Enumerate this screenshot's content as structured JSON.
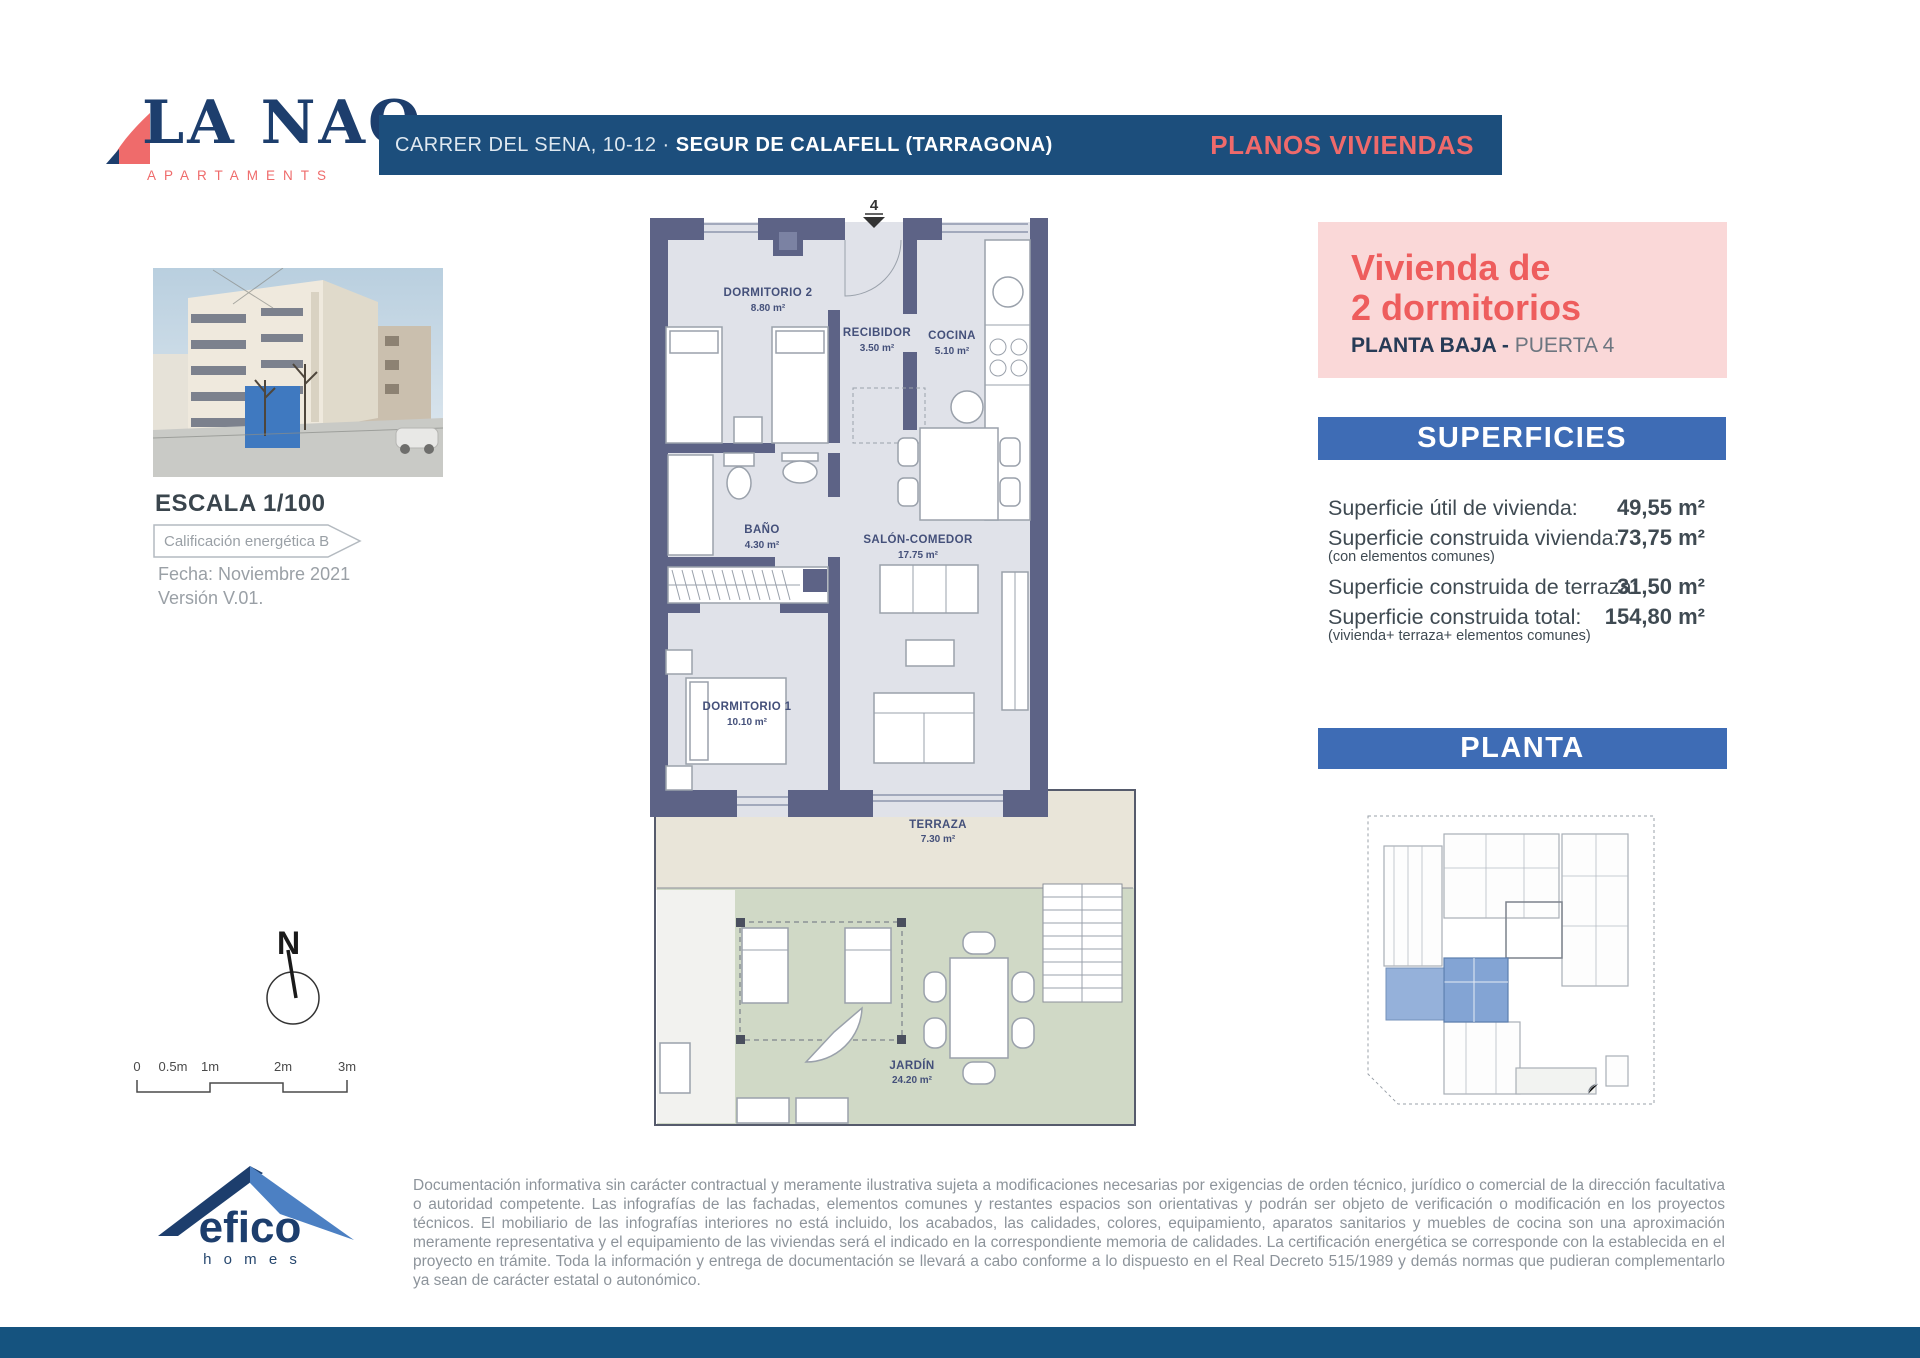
{
  "brand": {
    "name": "LA NAO",
    "tagline": "APARTAMENTS",
    "plans_label": "PLANOS VIVIENDAS",
    "address": {
      "street": "CARRER DEL SENA, 10-12",
      "separator": "·",
      "city": "SEGUR DE CALAFELL (TARRAGONA)"
    }
  },
  "unit": {
    "title_line1": "Vivienda de",
    "title_line2": "2 dormitorios",
    "floor": "PLANTA BAJA -",
    "door": "PUERTA 4"
  },
  "superficies": {
    "header": "SUPERFICIES",
    "rows": [
      {
        "label": "Superficie útil de vivienda:",
        "note": "",
        "value": "49,55 m²"
      },
      {
        "label": "Superficie construida vivienda:",
        "note": "(con elementos comunes)",
        "value": "73,75 m²"
      },
      {
        "label": "Superficie construida de terraza:",
        "note": "",
        "value": "31,50 m²"
      },
      {
        "label": "Superficie construida total:",
        "note": "(vivienda+ terraza+ elementos comunes)",
        "value": "154,80 m²"
      }
    ]
  },
  "planta": {
    "header": "PLANTA"
  },
  "side": {
    "escala": "ESCALA 1/100",
    "energy": "Calificación energética B",
    "fecha": "Fecha: Noviembre 2021",
    "version": "Versión V.01."
  },
  "floorplan": {
    "entry": "4",
    "rooms": [
      {
        "name": "DORMITORIO 2",
        "area": "8.80 m²"
      },
      {
        "name": "RECIBIDOR",
        "area": "3.50 m²"
      },
      {
        "name": "COCINA",
        "area": "5.10 m²"
      },
      {
        "name": "BAÑO",
        "area": "4.30 m²"
      },
      {
        "name": "SALÓN-COMEDOR",
        "area": "17.75 m²"
      },
      {
        "name": "DORMITORIO 1",
        "area": "10.10 m²"
      },
      {
        "name": "TERRAZA",
        "area": "7.30 m²"
      },
      {
        "name": "JARDÍN",
        "area": "24.20 m²"
      }
    ]
  },
  "scalebar": {
    "labels": [
      "0",
      "0.5m",
      "1m",
      "2m",
      "3m"
    ]
  },
  "north": {
    "label": "N"
  },
  "efico": {
    "name": "efico",
    "sub": "h o m e s"
  },
  "disclaimer": "Documentación informativa sin carácter contractual y meramente ilustrativa sujeta a modificaciones necesarias por exigencias de orden técnico, jurídico o comercial de la dirección facultativa o autoridad competente. Las infografías de las fachadas, elementos comunes y restantes espacios son orientativas y podrán ser objeto de verificación o modificación en los proyectos técnicos. El mobiliario de las infografías interiores no está incluido, los acabados, las calidades, colores, equipamiento, aparatos sanitarios y muebles de cocina son una aproximación meramente representativa y el equipamiento de las viviendas será el indicado en la correspondiente memoria de calidades. La certificación energética se corresponde con la establecida en el proyecto en trámite. Toda la información y entrega de documentación se llevará a cabo conforme a lo dispuesto en el Real Decreto 515/1989 y demás normas que pudieran complementarlo ya sean de carácter estatal o autonómico.",
  "colors": {
    "navy_bar": "#1c4e7c",
    "logo_navy": "#1d3e6d",
    "coral": "#ef6b6b",
    "title_red": "#ee5d5d",
    "pink_box": "#fad8d8",
    "section_blue": "#3e6cb5",
    "wall": "#5d6386",
    "floor": "#e0e2e9",
    "terrace": "#e9e5d9",
    "garden": "#d0d9c6",
    "unit_highlight": "#83a4d4",
    "footer": "#15537f"
  }
}
